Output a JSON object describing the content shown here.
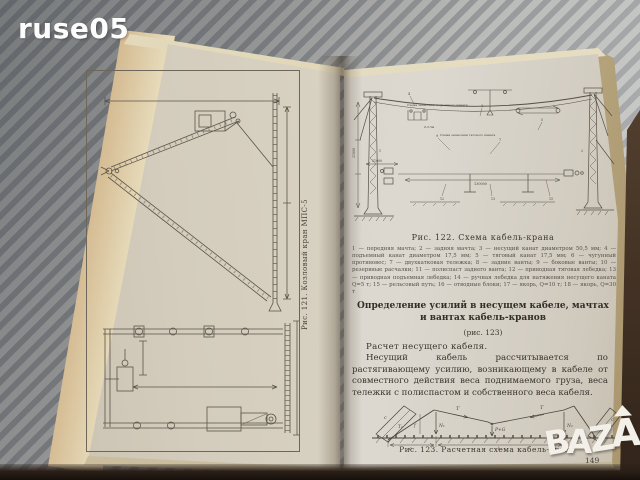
{
  "scene": {
    "background_base": "#b7b7b5",
    "background_stripe": "#8f9193",
    "page_cream": "#d8d2c3",
    "cover_brown": "#9c7f5c",
    "ink": "#3d3830",
    "watermark_white": "#f3f0ea"
  },
  "watermarks": {
    "top_left": "ruse05",
    "bazar": {
      "b": "B",
      "a1": "A",
      "z": "Z",
      "a2": "A",
      "r": "R"
    }
  },
  "left_page": {
    "fig121_caption": "Рис. 121. Козловый кран МПС-5"
  },
  "right_page": {
    "fig122": {
      "caption": "Рис. 122. Схема кабель-крана",
      "label_hoist_scheme": "Схема запасовки подъемного каната",
      "label_traction_scheme": "Схема запасовки тягового каната",
      "dim_hook": "0-3,5м",
      "dim_span": "130000",
      "dim_gauge": "21000",
      "dim_height": "21000",
      "numbers": [
        "1",
        "2",
        "3",
        "4",
        "5",
        "7",
        "9",
        "12",
        "13",
        "15"
      ],
      "legend": "1 — передняя мачта; 2 — задняя мачта; 3 — несущий канат диаметром 50,5 мм; 4 — подъемный канат диаметром 17,5 мм; 5 — тяговый канат 17,5 мм; 6 — чугунный противовес; 7 — двухкатковая тележка; 8 — задние ванты; 9 — боковые ванты; 10 — резервные расчалки; 11 — полиспаст заднего ванта; 12 — приводная тяговая лебедка; 13 — приводная подъемная лебедка; 14 — ручная лебедка для натяжения несущего каната Q=5 т; 15 — рельсовый путь; 16 — отводные блоки; 17 — якорь, Q=10 т; 18 — якорь, Q=30 т"
    },
    "heading": "Определение усилий в несущем кабеле, мачтах и вантах кабель-кранов",
    "heading_ref": "(рис. 123)",
    "para_lead": "Расчет несущего кабеля.",
    "para_body": "Несущий кабель рассчитывается по растягивающему усилию, возникающему в кабеле от совместного действия веса поднимаемого груза, веса тележки с полиспастом и собственного веса кабеля.",
    "fig123": {
      "caption": "Рис. 123. Расчетная схема кабель-крана",
      "labels": {
        "T_left": "T",
        "T_right": "T",
        "T1_left": "T₁",
        "T1_right": "T₁",
        "c_left": "c",
        "c_right": "c",
        "N1": "N₁",
        "N2": "N₂",
        "PG": "P+G",
        "f": "f",
        "a": "a",
        "l": "l"
      }
    },
    "page_number": "149"
  }
}
